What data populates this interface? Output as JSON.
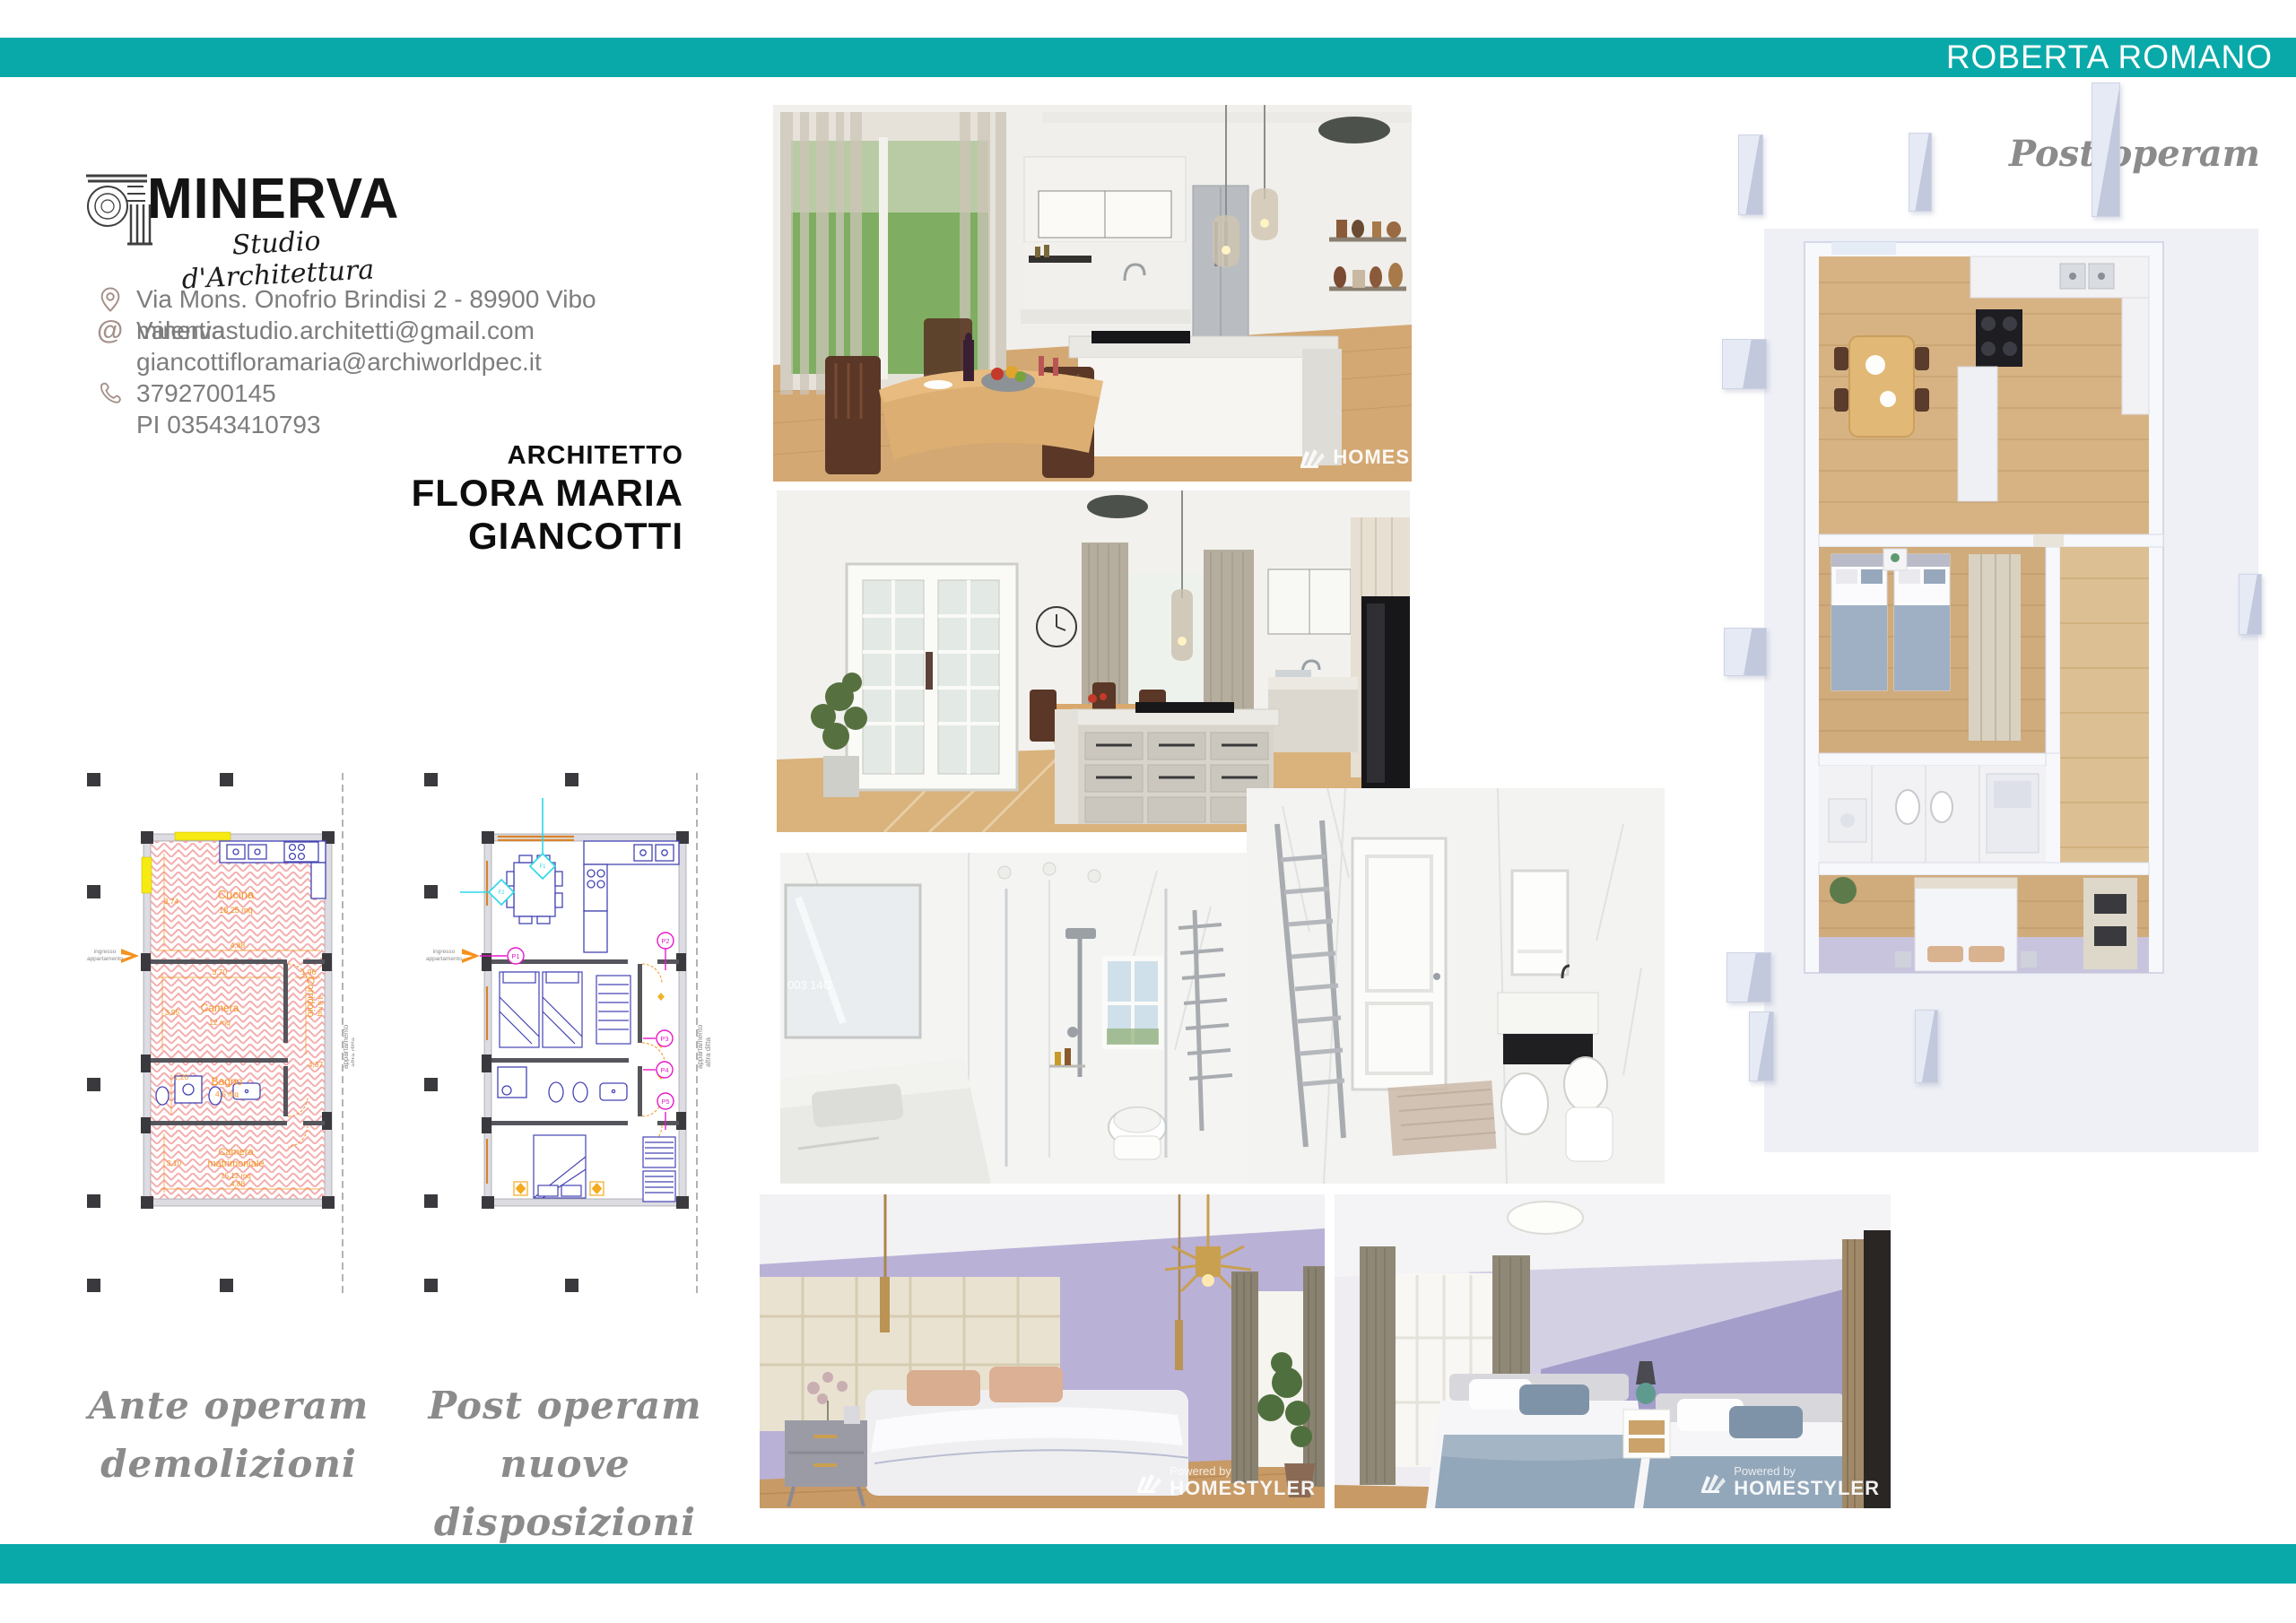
{
  "header": {
    "name": "ROBERTA ROMANO"
  },
  "accent_color": "#0aa9a9",
  "logo": {
    "title": "MINERVA",
    "subtitle": "Studio d'Architettura",
    "column_icon": "ionic-column-capital"
  },
  "contact": {
    "address": "Via Mons. Onofrio Brindisi 2 - 89900 Vibo Valentia",
    "email1": "minervastudio.architetti@gmail.com",
    "email2": "giancottifloramaria@archiworldpec.it",
    "phone": "3792700145",
    "vat": "PI 03543410793"
  },
  "architect": {
    "role": "ARCHITETTO",
    "name": "FLORA MARIA GIANCOTTI"
  },
  "plans": {
    "entrance_line1": "ingresso",
    "entrance_line2": "appartamento",
    "boundary_line1": "appartamento",
    "boundary_line2": "altra ditta",
    "ante": {
      "caption1": "Ante operam",
      "caption2": "demolizioni",
      "rooms": {
        "cucina": {
          "name": "Cucina",
          "area": "18,25 mq"
        },
        "camera": {
          "name": "Camera",
          "area": "12 mq"
        },
        "bagno": {
          "name": "Bagno",
          "area": "4,5 mq"
        },
        "corridoio": {
          "name": "Corridoio",
          "area": "4,8 mq"
        },
        "matrimoniale_1": "Camera",
        "matrimoniale_2": "matrimoniale",
        "matrimoniale_area": "15,12 mq"
      },
      "dims": {
        "v_cucina": "3,74",
        "w_cucina": "4,88",
        "w_camera": "3,70",
        "v_camera": "3,95",
        "w_corr": "1,96",
        "v_corr": "4,37",
        "v_bagno": "1,20",
        "v_matri": "3,10",
        "w_matri": "4,88"
      }
    },
    "post": {
      "caption1": "Post operam",
      "caption2": "nuove disposizioni",
      "tags": {
        "p1": "P1",
        "p2": "P2",
        "p3": "P3",
        "p4": "P4",
        "p5": "P5",
        "f1": "F1",
        "f2": "F2"
      }
    }
  },
  "plan3d": {
    "caption": "Post operam"
  },
  "watermark": {
    "powered_by": "Powered by",
    "brand": "HOMESTYLER",
    "brand_cut": "HOMES"
  }
}
